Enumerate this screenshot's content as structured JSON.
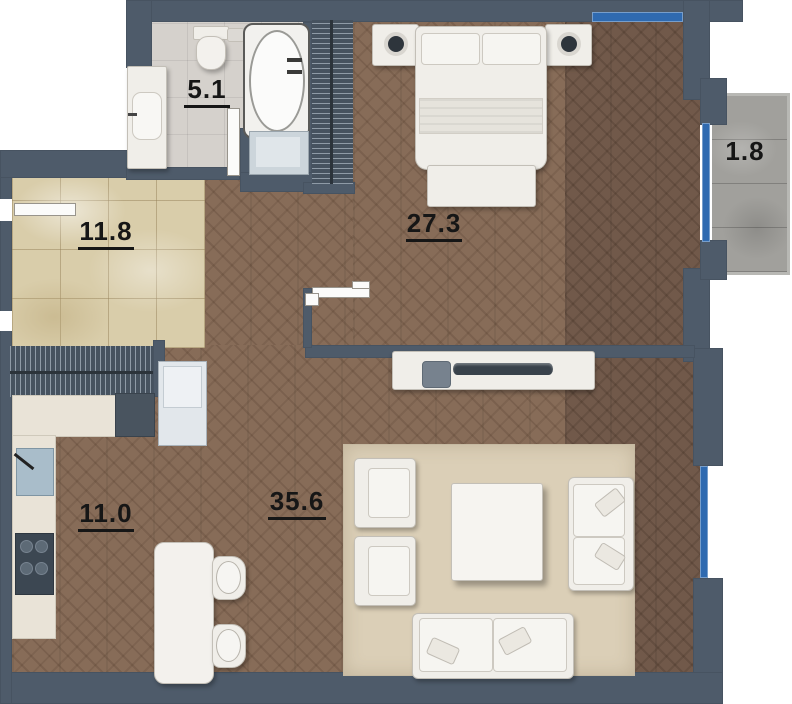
{
  "plan": {
    "title": "apartment-floor-plan",
    "rooms": [
      {
        "id": "bathroom",
        "area": "5.1"
      },
      {
        "id": "hallway",
        "area": "11.8"
      },
      {
        "id": "bedroom",
        "area": "27.3"
      },
      {
        "id": "balcony",
        "area": "1.8"
      },
      {
        "id": "kitchen",
        "area": "11.0"
      },
      {
        "id": "living-room",
        "area": "35.6"
      }
    ],
    "fixtures": {
      "bathroom": [
        "vanity-sink",
        "toilet",
        "bathtub",
        "washing-machine",
        "door"
      ],
      "bedroom": [
        "double-bed",
        "nightstand-left",
        "nightstand-right",
        "lamp-left",
        "lamp-right",
        "bench",
        "wardrobe",
        "sliding-door"
      ],
      "hallway": [
        "entry-door",
        "wardrobe"
      ],
      "kitchen": [
        "counter",
        "sink",
        "cooktop",
        "oven",
        "fridge",
        "dining-table",
        "chair",
        "chair"
      ],
      "living-room": [
        "tv-console",
        "tv",
        "speaker",
        "rug",
        "armchair",
        "armchair",
        "coffee-table",
        "loveseat-right",
        "loveseat-bottom"
      ],
      "windows": [
        "bedroom-top-window",
        "balcony-window",
        "living-room-window"
      ]
    },
    "colors": {
      "wall": "#4e5b6a",
      "outside": "#ffffff",
      "parquet_light": "#876c58",
      "parquet_dark": "#71594a",
      "hallway_tile": "#d9cdaa",
      "bathroom_tile": "#d5d1cc",
      "balcony_floor": "#a1a09c",
      "rug": "#dbcfb7",
      "furniture": "#f0eee9",
      "wardrobe": "#46525f",
      "window_glass": "#2f6ab0",
      "label_text": "#161616"
    }
  }
}
